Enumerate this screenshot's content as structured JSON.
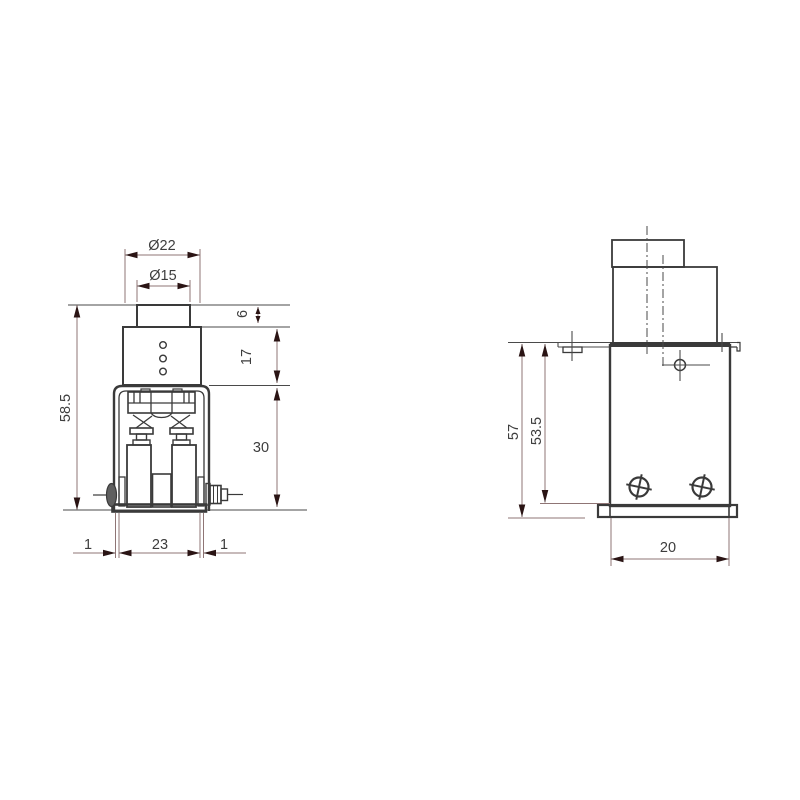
{
  "drawing": {
    "type": "engineering-dimension-drawing",
    "colors": {
      "background": "#ffffff",
      "object_line": "#3a3a3a",
      "dimension_line": "#8f7575",
      "arrowhead": "#2a1414",
      "text": "#3d3d3d"
    },
    "front_view": {
      "dimensions": {
        "top_diameter_outer": "Ø22",
        "top_diameter_inner": "Ø15",
        "knob_height": "6",
        "neck_height": "17",
        "housing_height": "30",
        "total_height": "58.5",
        "left_gap": "1",
        "base_width": "23",
        "right_gap": "1"
      }
    },
    "side_view": {
      "dimensions": {
        "total_height": "57",
        "body_height": "53.5",
        "body_width": "20"
      }
    }
  }
}
